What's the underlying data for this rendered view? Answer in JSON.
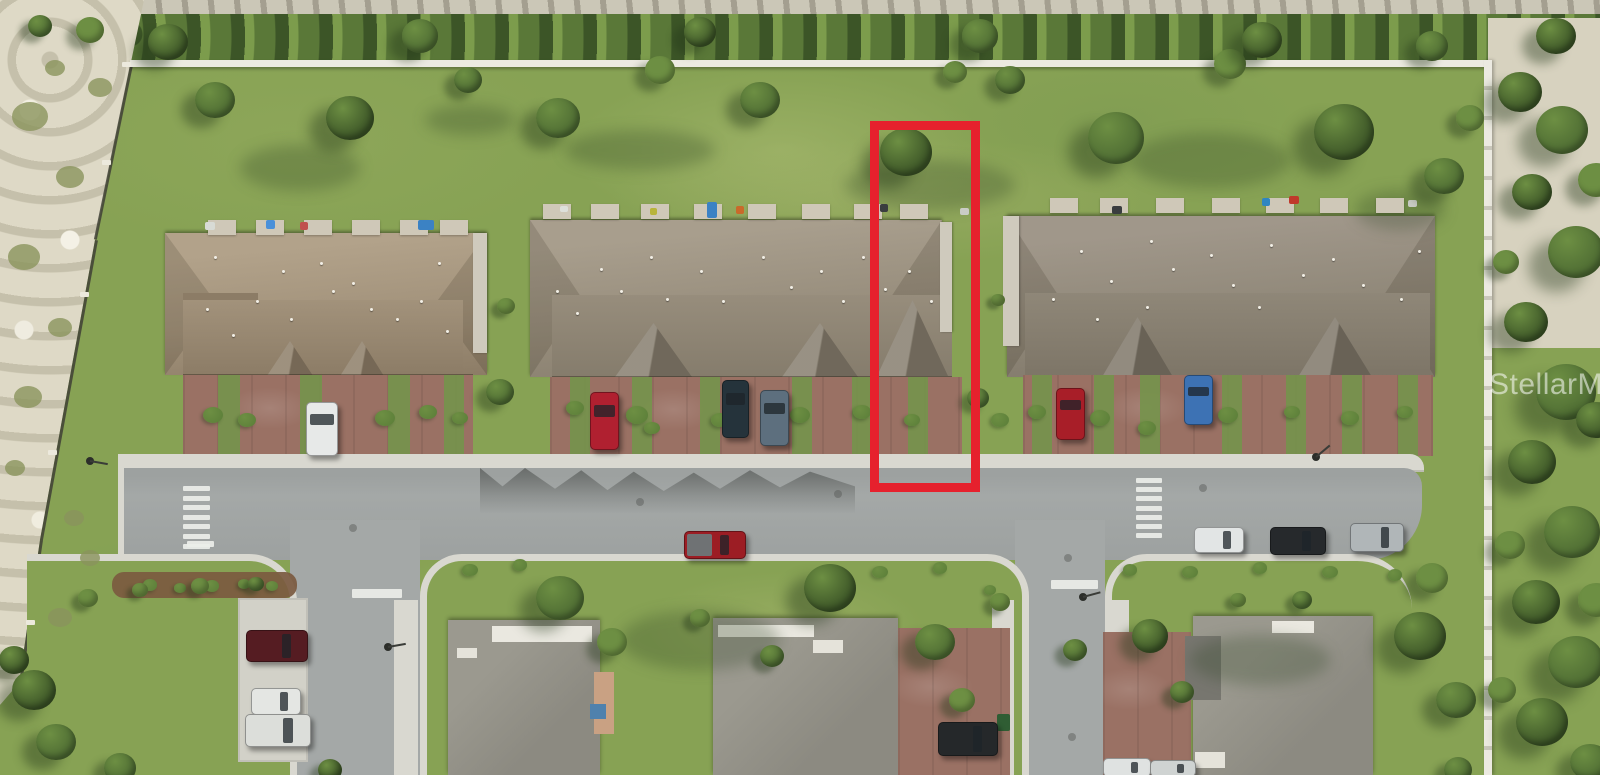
{
  "watermark": {
    "text": "StellarMLS",
    "x": 1489,
    "y": 368
  },
  "highlight": {
    "x": 870,
    "y": 121,
    "w": 92,
    "h": 353,
    "stroke": 9,
    "color": "#e6212d",
    "label": "red-outline-highlighted-townhouse-lot"
  },
  "palette": {
    "grass": "#87a254",
    "grassLight": "#9cb268",
    "grassDark": "#74934b",
    "hedge": "#5a7838",
    "hedgeLight": "#7c9c4c",
    "sand": "#ded9c6",
    "debris": "#cbc7b7",
    "sandRight": "#d7d2bf",
    "wall": "#eceae1",
    "fence": "#3f4036",
    "road": "#a4a8a7",
    "roadDark": "#8f9392",
    "sidewalk": "#d9d8d0",
    "concrete": "#d2d1c8",
    "paver": "#9a7164",
    "mulch": "#7b5a40",
    "roofLhi": "#b2a28a",
    "roofL": "#a2927b",
    "roofLdk": "#8c7c66",
    "roofMhi": "#a89e8d",
    "roofM": "#978d7c",
    "roofMdk": "#857c6c",
    "roofRhi": "#a0978a",
    "roofR": "#8f8778",
    "roofRdk": "#7d7567",
    "roofHouse": "#8c8a81",
    "roofHouseHi": "#9b998f",
    "ridgeWhite": "#eae8e0",
    "tree": "#4e6c33",
    "treeLight": "#6d8f43",
    "treeDark": "#3c5527",
    "shrub": "#5a7d38",
    "marking": "#eceee9",
    "watermarkColor": "rgba(255,255,255,0.55)"
  },
  "scene": {
    "trees": [
      [
        215,
        100,
        20,
        0
      ],
      [
        350,
        118,
        24,
        2
      ],
      [
        468,
        80,
        14,
        0
      ],
      [
        558,
        118,
        22,
        0
      ],
      [
        660,
        70,
        15,
        1
      ],
      [
        760,
        100,
        20,
        0
      ],
      [
        906,
        152,
        26,
        2
      ],
      [
        955,
        72,
        12,
        1
      ],
      [
        1010,
        80,
        15,
        0
      ],
      [
        1116,
        138,
        28,
        0
      ],
      [
        1230,
        64,
        16,
        1
      ],
      [
        1344,
        132,
        30,
        2
      ],
      [
        1444,
        176,
        20,
        0
      ],
      [
        1470,
        118,
        14,
        1
      ],
      [
        168,
        42,
        20,
        2
      ],
      [
        420,
        36,
        18,
        0
      ],
      [
        700,
        32,
        16,
        2
      ],
      [
        980,
        36,
        18,
        0
      ],
      [
        1262,
        40,
        20,
        2
      ],
      [
        1432,
        46,
        16,
        0
      ],
      [
        1556,
        36,
        20,
        2
      ],
      [
        90,
        30,
        14,
        1
      ],
      [
        40,
        26,
        12,
        0
      ],
      [
        500,
        392,
        14,
        0
      ],
      [
        506,
        306,
        9,
        1
      ],
      [
        978,
        398,
        11,
        0
      ],
      [
        998,
        300,
        7,
        1
      ],
      [
        560,
        598,
        24,
        0
      ],
      [
        612,
        642,
        15,
        1
      ],
      [
        700,
        618,
        10,
        1
      ],
      [
        772,
        656,
        12,
        0
      ],
      [
        830,
        588,
        26,
        2
      ],
      [
        935,
        642,
        20,
        0
      ],
      [
        962,
        700,
        13,
        1
      ],
      [
        1000,
        602,
        10,
        1
      ],
      [
        1075,
        650,
        12,
        0
      ],
      [
        1150,
        636,
        18,
        2
      ],
      [
        1182,
        692,
        12,
        0
      ],
      [
        1238,
        600,
        8,
        1
      ],
      [
        1302,
        600,
        10,
        0
      ],
      [
        1420,
        636,
        26,
        2
      ],
      [
        1456,
        700,
        20,
        0
      ],
      [
        1432,
        578,
        16,
        1
      ],
      [
        88,
        598,
        10,
        1
      ],
      [
        140,
        590,
        8,
        1
      ],
      [
        200,
        586,
        9,
        1
      ],
      [
        256,
        584,
        8,
        0
      ],
      [
        34,
        690,
        22,
        2
      ],
      [
        56,
        742,
        20,
        0
      ],
      [
        14,
        660,
        15,
        2
      ],
      [
        120,
        768,
        16,
        0
      ],
      [
        330,
        770,
        12,
        2
      ],
      [
        1458,
        770,
        14,
        0
      ],
      [
        1520,
        92,
        22,
        2
      ],
      [
        1562,
        130,
        26,
        0
      ],
      [
        1532,
        192,
        20,
        2
      ],
      [
        1576,
        252,
        28,
        0
      ],
      [
        1526,
        322,
        22,
        2
      ],
      [
        1566,
        392,
        30,
        0
      ],
      [
        1532,
        462,
        24,
        2
      ],
      [
        1572,
        532,
        28,
        0
      ],
      [
        1536,
        602,
        24,
        2
      ],
      [
        1576,
        662,
        28,
        0
      ],
      [
        1542,
        722,
        26,
        2
      ],
      [
        1590,
        762,
        20,
        0
      ],
      [
        1506,
        262,
        13,
        1
      ],
      [
        1510,
        545,
        15,
        1
      ],
      [
        1502,
        690,
        14,
        1
      ],
      [
        1596,
        180,
        18,
        1
      ],
      [
        1596,
        420,
        20,
        2
      ],
      [
        1596,
        600,
        18,
        1
      ]
    ],
    "shrubs": [
      [
        213,
        415,
        10
      ],
      [
        247,
        420,
        9
      ],
      [
        385,
        418,
        10
      ],
      [
        428,
        412,
        9
      ],
      [
        460,
        418,
        8
      ],
      [
        575,
        408,
        9
      ],
      [
        637,
        415,
        11
      ],
      [
        652,
        428,
        8
      ],
      [
        720,
        420,
        9
      ],
      [
        800,
        415,
        10
      ],
      [
        862,
        412,
        9
      ],
      [
        912,
        420,
        8
      ],
      [
        1037,
        412,
        9
      ],
      [
        1100,
        418,
        10
      ],
      [
        1147,
        428,
        9
      ],
      [
        1228,
        415,
        10
      ],
      [
        1292,
        412,
        8
      ],
      [
        1350,
        418,
        9
      ],
      [
        1405,
        412,
        8
      ],
      [
        1000,
        420,
        9
      ],
      [
        150,
        585,
        7
      ],
      [
        180,
        588,
        6
      ],
      [
        212,
        586,
        7
      ],
      [
        244,
        584,
        6
      ],
      [
        272,
        586,
        6
      ],
      [
        470,
        570,
        8
      ],
      [
        520,
        565,
        7
      ],
      [
        880,
        572,
        8
      ],
      [
        940,
        568,
        7
      ],
      [
        990,
        590,
        6
      ],
      [
        1130,
        570,
        7
      ],
      [
        1190,
        572,
        8
      ],
      [
        1260,
        568,
        7
      ],
      [
        1330,
        572,
        8
      ],
      [
        1395,
        575,
        7
      ]
    ],
    "scrub": [
      [
        30,
        120,
        18
      ],
      [
        70,
        180,
        14
      ],
      [
        24,
        260,
        16
      ],
      [
        60,
        330,
        12
      ],
      [
        28,
        400,
        14
      ],
      [
        74,
        520,
        10
      ],
      [
        100,
        90,
        12
      ],
      [
        55,
        70,
        10
      ],
      [
        15,
        470,
        10
      ],
      [
        90,
        560,
        10
      ],
      [
        60,
        620,
        12
      ]
    ],
    "shades": [
      [
        300,
        168,
        120,
        46
      ],
      [
        640,
        150,
        150,
        40
      ],
      [
        930,
        185,
        170,
        50
      ],
      [
        1210,
        160,
        160,
        55
      ],
      [
        470,
        120,
        90,
        30
      ],
      [
        1400,
        210,
        90,
        40
      ],
      [
        700,
        640,
        160,
        60
      ],
      [
        1260,
        660,
        140,
        50
      ]
    ],
    "patio_pads": {
      "rows": [
        {
          "y": 220,
          "xs": [
            208,
            256,
            304,
            352,
            400,
            440
          ]
        },
        {
          "y": 204,
          "xs": [
            543,
            591,
            641,
            694,
            748,
            802,
            854,
            900
          ]
        },
        {
          "y": 198,
          "xs": [
            1050,
            1100,
            1156,
            1212,
            1266,
            1320,
            1376
          ]
        }
      ],
      "w": 28,
      "h": 15
    },
    "patio_items": [
      [
        707,
        202,
        10,
        16,
        "#3b82c4"
      ],
      [
        418,
        220,
        16,
        10,
        "#3b82c4"
      ],
      [
        266,
        220,
        9,
        9,
        "#4a90d9"
      ],
      [
        300,
        222,
        8,
        8,
        "#c0504d"
      ],
      [
        1289,
        196,
        10,
        8,
        "#c0392b"
      ],
      [
        736,
        206,
        8,
        8,
        "#c96a2a"
      ],
      [
        1112,
        206,
        10,
        8,
        "#3a3d3f"
      ],
      [
        880,
        204,
        8,
        8,
        "#3a3d3f"
      ],
      [
        1262,
        198,
        8,
        8,
        "#2e86c1"
      ],
      [
        560,
        206,
        8,
        6,
        "#dde0da"
      ],
      [
        205,
        222,
        10,
        8,
        "#d8dbd5"
      ],
      [
        960,
        208,
        9,
        7,
        "#caccc6"
      ],
      [
        1408,
        200,
        9,
        7,
        "#caccc6"
      ],
      [
        650,
        208,
        7,
        7,
        "#b8b43a"
      ],
      [
        997,
        714,
        13,
        17,
        "#2f5d33"
      ],
      [
        965,
        726,
        10,
        12,
        "#3a3d3f"
      ]
    ],
    "roof_vents": [
      [
        206,
        308
      ],
      [
        232,
        334
      ],
      [
        256,
        300
      ],
      [
        290,
        318
      ],
      [
        320,
        262
      ],
      [
        332,
        290
      ],
      [
        370,
        308
      ],
      [
        396,
        318
      ],
      [
        420,
        300
      ],
      [
        446,
        330
      ],
      [
        214,
        256
      ],
      [
        282,
        270
      ],
      [
        352,
        282
      ],
      [
        438,
        262
      ],
      [
        600,
        268
      ],
      [
        620,
        290
      ],
      [
        650,
        256
      ],
      [
        666,
        298
      ],
      [
        700,
        270
      ],
      [
        722,
        300
      ],
      [
        762,
        256
      ],
      [
        790,
        286
      ],
      [
        820,
        270
      ],
      [
        842,
        300
      ],
      [
        862,
        256
      ],
      [
        884,
        288
      ],
      [
        908,
        270
      ],
      [
        930,
        300
      ],
      [
        556,
        290
      ],
      [
        576,
        312
      ],
      [
        1080,
        250
      ],
      [
        1110,
        280
      ],
      [
        1150,
        240
      ],
      [
        1172,
        268
      ],
      [
        1210,
        254
      ],
      [
        1232,
        284
      ],
      [
        1270,
        244
      ],
      [
        1302,
        274
      ],
      [
        1332,
        258
      ],
      [
        1362,
        284
      ],
      [
        1400,
        298
      ],
      [
        1418,
        250
      ],
      [
        1052,
        298
      ],
      [
        1096,
        318
      ],
      [
        1146,
        306
      ],
      [
        1258,
        306
      ]
    ],
    "crosswalks": [
      {
        "x": 183,
        "y": 486,
        "count": 7,
        "w": 27,
        "h": 5,
        "gap": 4.6
      },
      {
        "x": 1136,
        "y": 478,
        "count": 7,
        "w": 26,
        "h": 5,
        "gap": 4.2
      }
    ],
    "stop_bars": [
      {
        "x": 352,
        "y": 589,
        "w": 50,
        "h": 9
      },
      {
        "x": 1051,
        "y": 580,
        "w": 47,
        "h": 9
      },
      {
        "x": 187,
        "y": 541,
        "w": 27,
        "h": 6
      }
    ],
    "manholes": [
      [
        353,
        528
      ],
      [
        838,
        494
      ],
      [
        1068,
        558
      ],
      [
        1072,
        737
      ],
      [
        1203,
        488
      ],
      [
        640,
        502
      ]
    ],
    "lamps": [
      {
        "x": 90,
        "y": 461,
        "deg": 10
      },
      {
        "x": 388,
        "y": 647,
        "deg": -10
      },
      {
        "x": 1083,
        "y": 597,
        "deg": -15
      },
      {
        "x": 1316,
        "y": 457,
        "deg": -40
      }
    ],
    "fence_posts": [
      [
        126,
        64
      ],
      [
        106,
        162
      ],
      [
        84,
        294
      ],
      [
        52,
        452
      ],
      [
        30,
        622
      ]
    ],
    "vehicles": [
      {
        "name": "white-car-left-driveway",
        "x": 306,
        "y": 402,
        "w": 30,
        "h": 52,
        "dir": "v",
        "color": "#e7e9e8"
      },
      {
        "name": "red-car-center-driveway",
        "x": 590,
        "y": 392,
        "w": 27,
        "h": 56,
        "dir": "v",
        "color": "#b02030"
      },
      {
        "name": "dark-car-center-driveway",
        "x": 722,
        "y": 380,
        "w": 25,
        "h": 56,
        "dir": "v",
        "color": "#25333b"
      },
      {
        "name": "slate-car-center-driveway",
        "x": 760,
        "y": 390,
        "w": 27,
        "h": 54,
        "dir": "v",
        "color": "#5d6f7e"
      },
      {
        "name": "red-car-right-driveway",
        "x": 1056,
        "y": 388,
        "w": 27,
        "h": 50,
        "dir": "v",
        "color": "#a81e28"
      },
      {
        "name": "blue-car-right-driveway",
        "x": 1184,
        "y": 375,
        "w": 27,
        "h": 48,
        "dir": "v",
        "color": "#3d72b4"
      },
      {
        "name": "red-pickup-truck-road",
        "x": 684,
        "y": 531,
        "w": 60,
        "h": 26,
        "dir": "h",
        "color": "#9c1d24",
        "bed": "#6f7274"
      },
      {
        "name": "white-car-road",
        "x": 1194,
        "y": 527,
        "w": 48,
        "h": 24,
        "dir": "h",
        "color": "#e2e5e5"
      },
      {
        "name": "black-car-road",
        "x": 1270,
        "y": 527,
        "w": 54,
        "h": 26,
        "dir": "h",
        "color": "#26292c"
      },
      {
        "name": "silver-car-road",
        "x": 1350,
        "y": 523,
        "w": 52,
        "h": 27,
        "dir": "h",
        "color": "#b0b6b8"
      },
      {
        "name": "maroon-suv-parking",
        "x": 246,
        "y": 630,
        "w": 60,
        "h": 30,
        "dir": "h",
        "color": "#551c22"
      },
      {
        "name": "white-car-parking",
        "x": 251,
        "y": 688,
        "w": 48,
        "h": 25,
        "dir": "h",
        "color": "#e4e6e3"
      },
      {
        "name": "white-suv-parking",
        "x": 245,
        "y": 714,
        "w": 64,
        "h": 31,
        "dir": "h",
        "color": "#dcdeda"
      },
      {
        "name": "dark-truck-bottom-driveway",
        "x": 938,
        "y": 722,
        "w": 58,
        "h": 32,
        "dir": "h",
        "color": "#25282a"
      },
      {
        "name": "white-car-bottom-edge-1",
        "x": 1103,
        "y": 758,
        "w": 46,
        "h": 17,
        "dir": "h",
        "color": "#dfe2e1"
      },
      {
        "name": "white-car-bottom-edge-2",
        "x": 1150,
        "y": 760,
        "w": 44,
        "h": 15,
        "dir": "h",
        "color": "#cfd3d2"
      }
    ]
  }
}
